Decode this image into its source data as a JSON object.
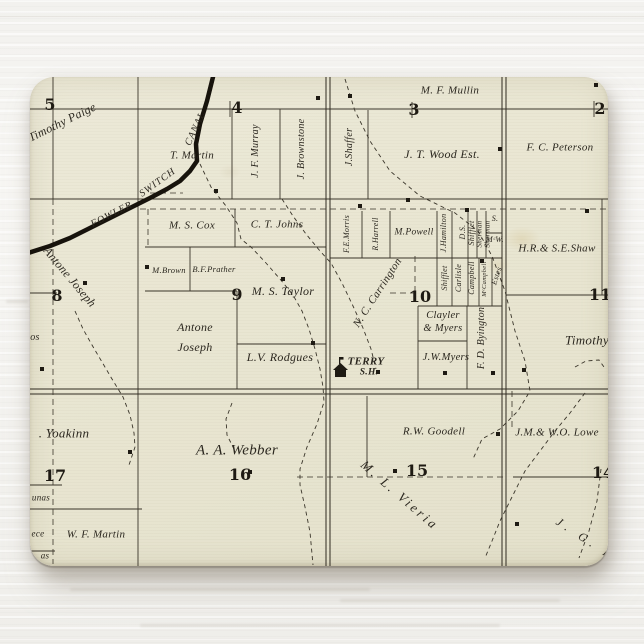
{
  "colors": {
    "paper": "#e9e6d2",
    "ink": "#2b271f",
    "grid_ink": "#3a352a",
    "canal_ink": "#17130c",
    "wood_background": "#f4f3f0",
    "stain": "rgba(185,150,70,0.16)"
  },
  "icons": {
    "schoolhouse": "schoolhouse-icon",
    "building_marker": "building-square-marker"
  },
  "map": {
    "canal_name_parts": [
      "FOWLER",
      "SWITCH",
      "CANAL"
    ],
    "school": {
      "name": "TERRY",
      "type": "S.H."
    },
    "sections": [
      {
        "n": "5",
        "x": 20,
        "y": 28
      },
      {
        "n": "4",
        "x": 207,
        "y": 31
      },
      {
        "n": "3",
        "x": 384,
        "y": 33
      },
      {
        "n": "2",
        "x": 570,
        "y": 32
      },
      {
        "n": "8",
        "x": 27,
        "y": 219
      },
      {
        "n": "9",
        "x": 207,
        "y": 218
      },
      {
        "n": "10",
        "x": 390,
        "y": 220
      },
      {
        "n": "11",
        "x": 570,
        "y": 218
      },
      {
        "n": "17",
        "x": 25,
        "y": 399
      },
      {
        "n": "16",
        "x": 210,
        "y": 398
      },
      {
        "n": "15",
        "x": 387,
        "y": 394
      },
      {
        "n": "14",
        "x": 573,
        "y": 396
      }
    ],
    "labels": [
      {
        "t": "Timothy Paige",
        "x": 32,
        "y": 45,
        "r": -26,
        "s": 12
      },
      {
        "t": "T. Martin",
        "x": 162,
        "y": 79,
        "s": 11
      },
      {
        "t": "J. F. Murray",
        "x": 226,
        "y": 74,
        "r": -90,
        "s": 10
      },
      {
        "t": "J. Brownstone",
        "x": 272,
        "y": 72,
        "r": -90,
        "s": 10
      },
      {
        "t": "M. F. Mullin",
        "x": 420,
        "y": 14,
        "s": 11
      },
      {
        "t": "J.Shaffer",
        "x": 320,
        "y": 70,
        "r": -90,
        "s": 10
      },
      {
        "t": "J. T. Wood Est.",
        "x": 412,
        "y": 77,
        "s": 12
      },
      {
        "t": "F. C. Peterson",
        "x": 530,
        "y": 71,
        "s": 11
      },
      {
        "t": "FOWLER",
        "x": 82,
        "y": 138,
        "r": -27,
        "s": 10,
        "sp": 1
      },
      {
        "t": "SWITCH",
        "x": 128,
        "y": 106,
        "r": -36,
        "s": 10,
        "sp": 1
      },
      {
        "t": "CANAL",
        "x": 166,
        "y": 52,
        "r": -65,
        "s": 10,
        "sp": 1
      },
      {
        "t": "Antone Joseph",
        "x": 40,
        "y": 200,
        "r": 50,
        "s": 12
      },
      {
        "t": "os",
        "x": 5,
        "y": 261,
        "s": 10
      },
      {
        "t": "M. S. Cox",
        "x": 162,
        "y": 149,
        "s": 11
      },
      {
        "t": "C. T. Johns",
        "x": 247,
        "y": 148,
        "s": 11
      },
      {
        "t": "M.Brown",
        "x": 139,
        "y": 193,
        "s": 8.5
      },
      {
        "t": "B.F.Prather",
        "x": 184,
        "y": 192,
        "s": 8.5
      },
      {
        "t": "M. S. Taylor",
        "x": 253,
        "y": 214,
        "s": 12
      },
      {
        "t": "Antone",
        "x": 165,
        "y": 250,
        "s": 12
      },
      {
        "t": "Joseph",
        "x": 165,
        "y": 270,
        "s": 12
      },
      {
        "t": "L.V. Rodgues",
        "x": 250,
        "y": 280,
        "s": 12
      },
      {
        "t": "F.E.Morris",
        "x": 317,
        "y": 157,
        "r": -90,
        "s": 8
      },
      {
        "t": "R.Harrell",
        "x": 346,
        "y": 157,
        "r": -90,
        "s": 8
      },
      {
        "t": "M.Powell",
        "x": 384,
        "y": 156,
        "s": 9.5
      },
      {
        "t": "J.Hamilton",
        "x": 414,
        "y": 156,
        "r": -90,
        "s": 8
      },
      {
        "t": "D.S.",
        "x": 433,
        "y": 155,
        "r": -90,
        "s": 8
      },
      {
        "t": "Shifflet",
        "x": 442,
        "y": 156,
        "r": -90,
        "s": 8
      },
      {
        "t": "Sherman",
        "x": 450,
        "y": 157,
        "r": -90,
        "s": 7
      },
      {
        "t": "Sherman",
        "x": 458,
        "y": 157,
        "r": -90,
        "s": 7
      },
      {
        "t": "S.",
        "x": 465,
        "y": 142,
        "s": 8
      },
      {
        "t": "MᶜW.",
        "x": 465,
        "y": 163,
        "s": 8
      },
      {
        "t": "Shifflet",
        "x": 415,
        "y": 201,
        "r": -90,
        "s": 8
      },
      {
        "t": "Carlisle",
        "x": 429,
        "y": 201,
        "r": -90,
        "s": 8
      },
      {
        "t": "Campbell",
        "x": 442,
        "y": 201,
        "r": -90,
        "s": 8
      },
      {
        "t": "MᶜCampbell",
        "x": 455,
        "y": 202,
        "r": -90,
        "s": 6.5
      },
      {
        "t": "Estes",
        "x": 467,
        "y": 199,
        "r": -72,
        "s": 8
      },
      {
        "t": "N. C. Carrington",
        "x": 348,
        "y": 216,
        "r": -57,
        "s": 11
      },
      {
        "t": "Clayler",
        "x": 413,
        "y": 239,
        "s": 10.5
      },
      {
        "t": "& Myers",
        "x": 413,
        "y": 252,
        "s": 10.5
      },
      {
        "t": "J.W.Myers",
        "x": 416,
        "y": 281,
        "s": 10.5
      },
      {
        "t": "F. D. Byington",
        "x": 452,
        "y": 261,
        "r": -90,
        "s": 10
      },
      {
        "t": "TERRY",
        "x": 336,
        "y": 285,
        "s": 11,
        "b": 1
      },
      {
        "t": "S.H.",
        "x": 339,
        "y": 296,
        "s": 9.5,
        "b": 1
      },
      {
        "t": "H.R.& S.E.Shaw",
        "x": 527,
        "y": 172,
        "s": 11
      },
      {
        "t": "Timothy",
        "x": 557,
        "y": 263,
        "s": 13
      },
      {
        "t": ". Yoakinn",
        "x": 34,
        "y": 356,
        "s": 13
      },
      {
        "t": "A. A. Webber",
        "x": 207,
        "y": 374,
        "s": 15
      },
      {
        "t": "M. L. Vieria",
        "x": 370,
        "y": 418,
        "r": 41,
        "s": 13,
        "sp": 3
      },
      {
        "t": "R.W. Goodell",
        "x": 404,
        "y": 355,
        "s": 11
      },
      {
        "t": "J.M.& W.O. Lowe",
        "x": 527,
        "y": 356,
        "s": 11
      },
      {
        "t": "W. F. Martin",
        "x": 66,
        "y": 458,
        "s": 11
      },
      {
        "t": "unas",
        "x": 11,
        "y": 421,
        "s": 9
      },
      {
        "t": "ece",
        "x": 8,
        "y": 457,
        "s": 9
      },
      {
        "t": "as",
        "x": 15,
        "y": 479,
        "s": 9
      },
      {
        "t": "J. G. E",
        "x": 556,
        "y": 462,
        "r": 33,
        "s": 12,
        "sp": 5
      }
    ],
    "building_markers": [
      [
        186,
        114
      ],
      [
        288,
        21
      ],
      [
        320,
        19
      ],
      [
        470,
        72
      ],
      [
        566,
        8
      ],
      [
        557,
        134
      ],
      [
        55,
        206
      ],
      [
        12,
        292
      ],
      [
        117,
        190
      ],
      [
        253,
        202
      ],
      [
        283,
        266
      ],
      [
        378,
        123
      ],
      [
        330,
        129
      ],
      [
        437,
        133
      ],
      [
        452,
        184
      ],
      [
        415,
        296
      ],
      [
        463,
        296
      ],
      [
        348,
        295
      ],
      [
        494,
        293
      ],
      [
        100,
        375
      ],
      [
        220,
        395
      ],
      [
        365,
        394
      ],
      [
        468,
        357
      ],
      [
        487,
        447
      ]
    ]
  }
}
